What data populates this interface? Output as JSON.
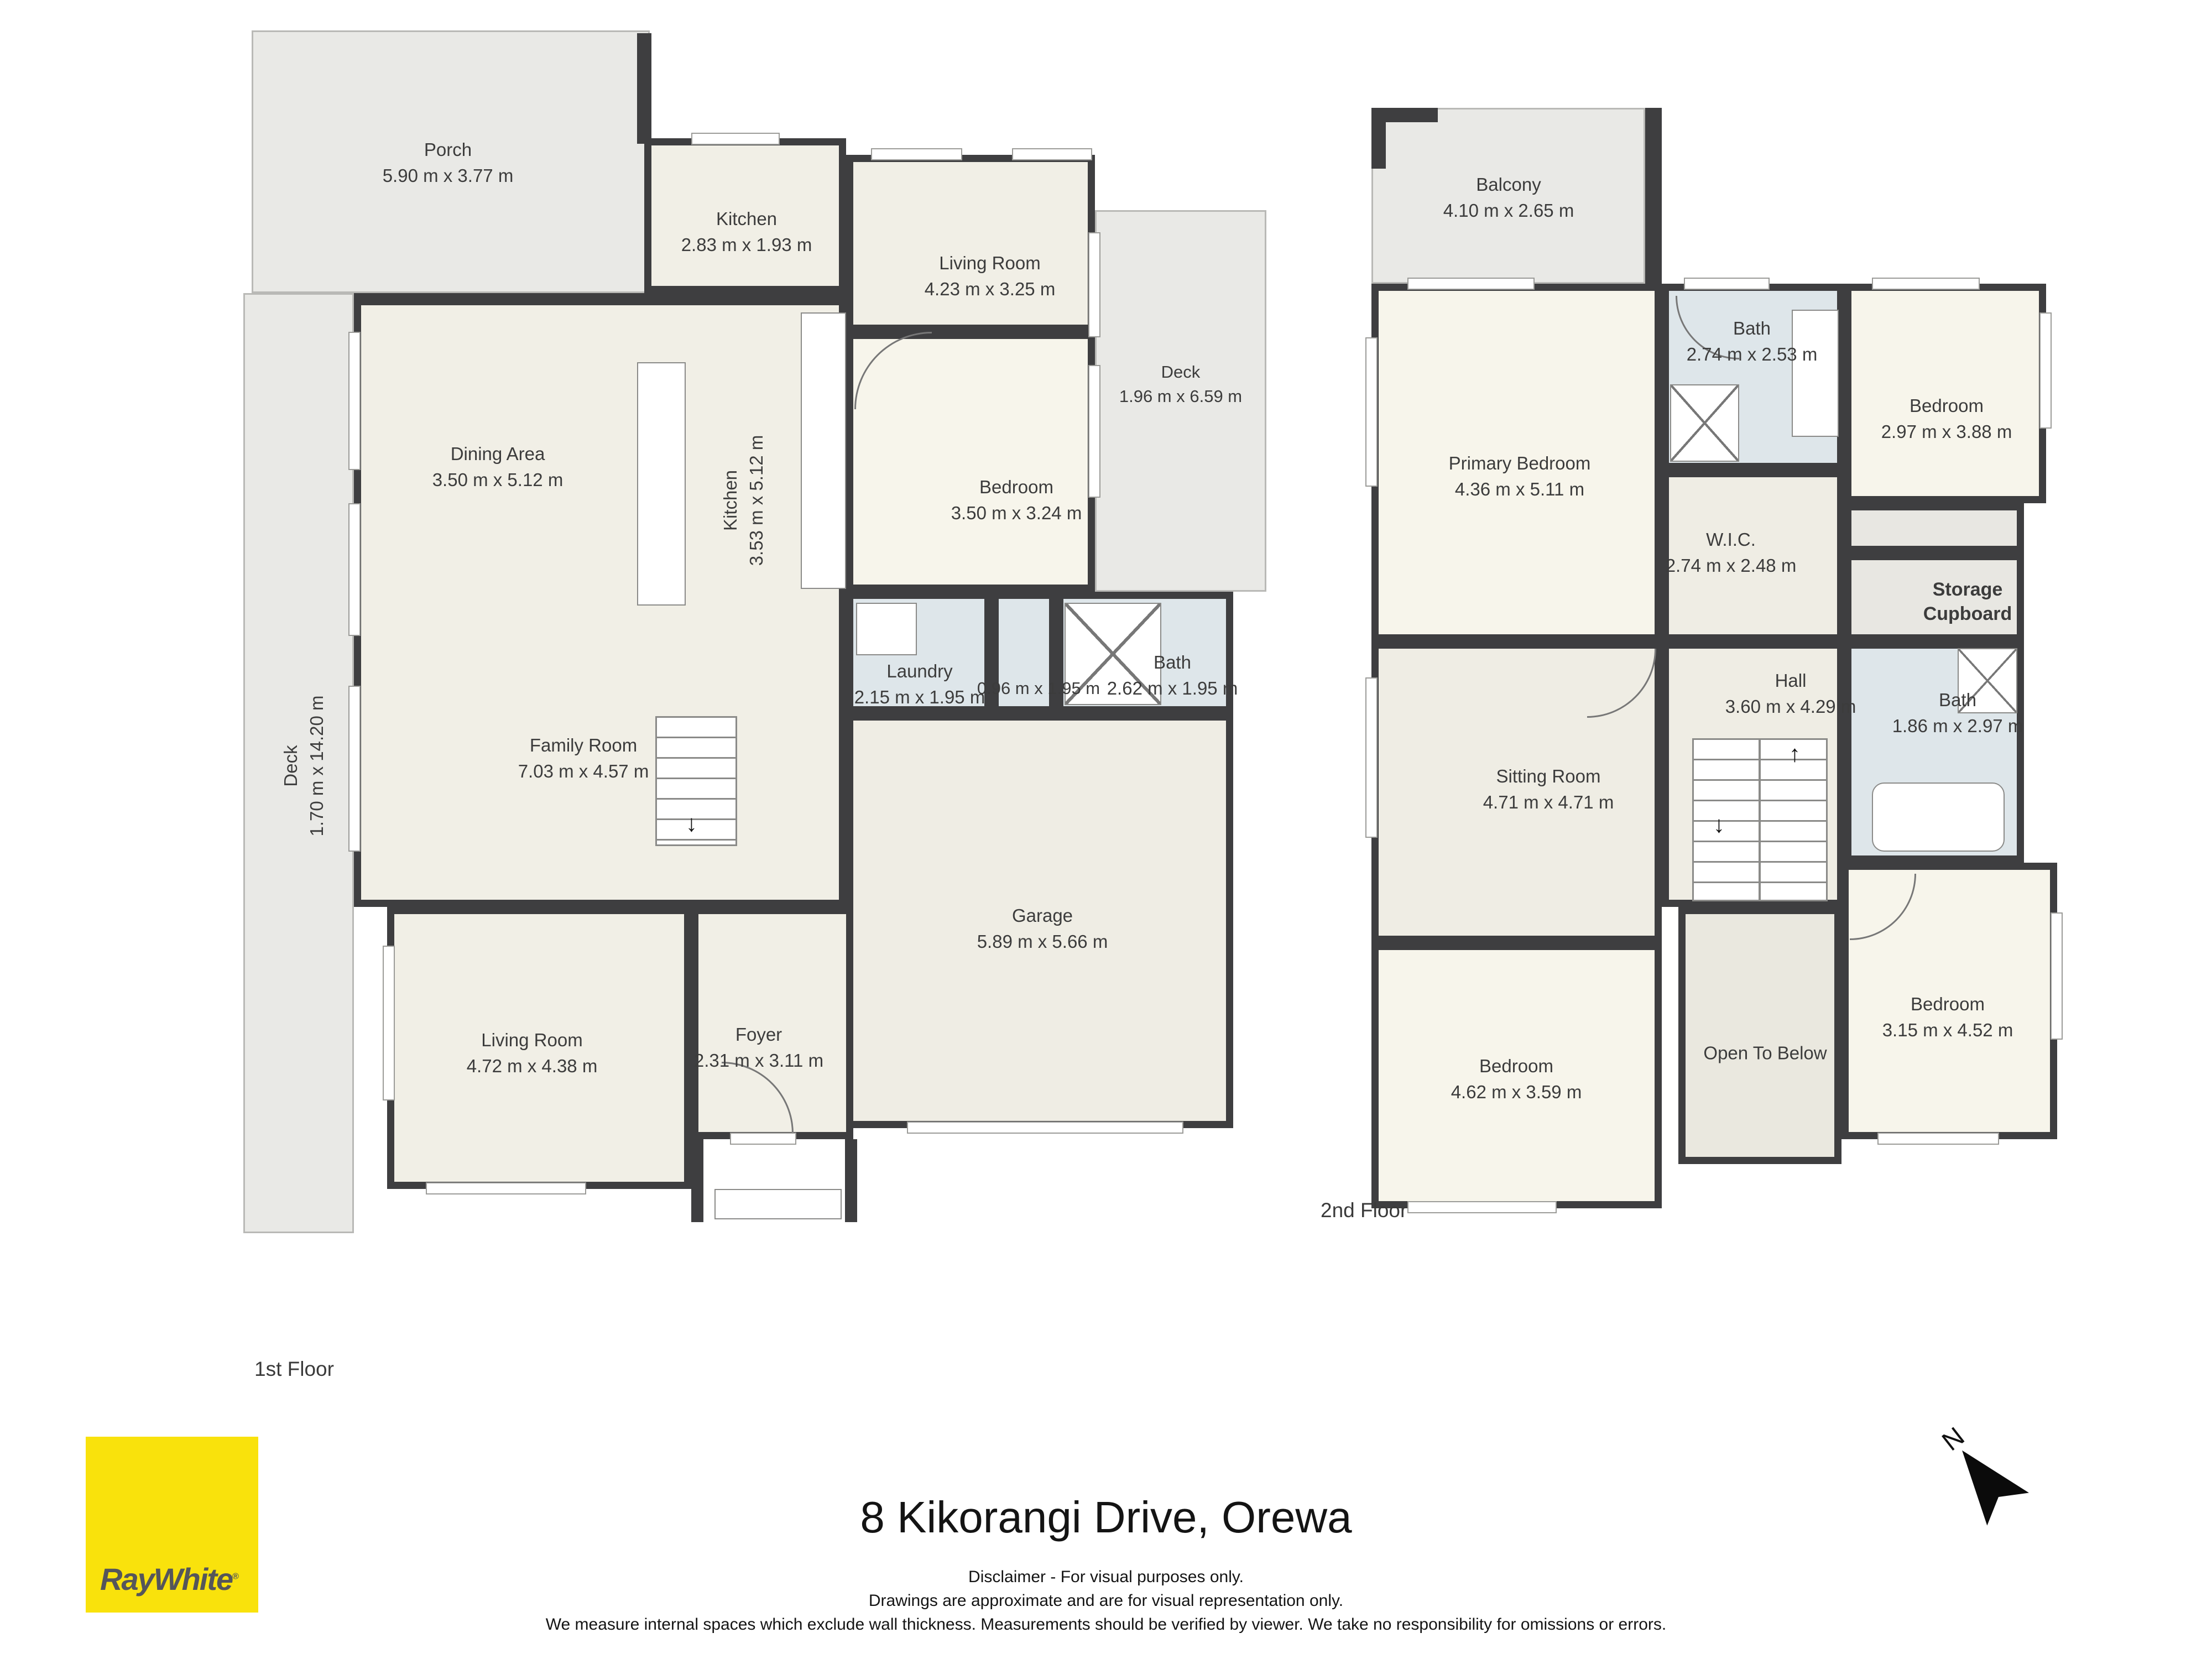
{
  "floor1": {
    "label": "1st Floor",
    "rooms": [
      {
        "name": "Porch",
        "dims": "5.90 m x 3.77 m"
      },
      {
        "name": "Kitchen",
        "dims": "2.83 m x 1.93 m"
      },
      {
        "name": "Living Room",
        "dims": "4.23 m x 3.25 m"
      },
      {
        "name": "Deck",
        "dims": "1.96 m x 6.59 m"
      },
      {
        "name": "Dining Area",
        "dims": "3.50 m x 5.12 m"
      },
      {
        "name": "Kitchen",
        "dims": "3.53 m x 5.12 m"
      },
      {
        "name": "Bedroom",
        "dims": "3.50 m x 3.24 m"
      },
      {
        "name": "Laundry",
        "dims": "2.15 m x 1.95 m"
      },
      {
        "name": "",
        "dims": "0.96 m x 1.95 m"
      },
      {
        "name": "Bath",
        "dims": "2.62 m x 1.95 m"
      },
      {
        "name": "Family Room",
        "dims": "7.03 m x 4.57 m"
      },
      {
        "name": "Deck",
        "dims": "1.70 m x 14.20 m"
      },
      {
        "name": "Living Room",
        "dims": "4.72 m x 4.38 m"
      },
      {
        "name": "Foyer",
        "dims": "2.31 m x 3.11 m"
      },
      {
        "name": "Garage",
        "dims": "5.89 m x 5.66 m"
      }
    ]
  },
  "floor2": {
    "label": "2nd Floor",
    "rooms": [
      {
        "name": "Balcony",
        "dims": "4.10 m x 2.65 m"
      },
      {
        "name": "Primary Bedroom",
        "dims": "4.36 m x 5.11 m"
      },
      {
        "name": "Bath",
        "dims": "2.74 m x 2.53 m"
      },
      {
        "name": "Bedroom",
        "dims": "2.97 m x 3.88 m"
      },
      {
        "name": "W.I.C.",
        "dims": "2.74 m x 2.48 m"
      },
      {
        "name": "Storage Cupboard",
        "dims": ""
      },
      {
        "name": "Hall",
        "dims": "3.60 m x 4.29 m"
      },
      {
        "name": "Bath",
        "dims": "1.86 m x 2.97 m"
      },
      {
        "name": "Sitting Room",
        "dims": "4.71 m x 4.71 m"
      },
      {
        "name": "Open To Below",
        "dims": ""
      },
      {
        "name": "Bedroom",
        "dims": "4.62 m x 3.59 m"
      },
      {
        "name": "Bedroom",
        "dims": "3.15 m x 4.52 m"
      }
    ]
  },
  "footer": {
    "title": "8 Kikorangi Drive, Orewa",
    "disclaimer_line1": "Disclaimer - For visual purposes only.",
    "disclaimer_line2": "Drawings are approximate and are for visual representation only.",
    "disclaimer_line3": "We measure internal spaces which exclude wall thickness. Measurements should be verified by viewer. We take no responsibility for omissions or errors.",
    "logo_text": "RayWhite",
    "logo_reg": "®"
  },
  "icons": {
    "north": "N",
    "up_arrow": "↑",
    "down_arrow": "↓"
  },
  "colors": {
    "wall": "#3E3E40",
    "living_floor": "#F1EFE6",
    "bedroom_floor": "#F7F5EB",
    "bath_floor": "#DEE6EA",
    "deck_floor": "#E9E9E6",
    "raywhite_yellow": "#F9E20C",
    "logo_text_gray": "#55565A"
  }
}
